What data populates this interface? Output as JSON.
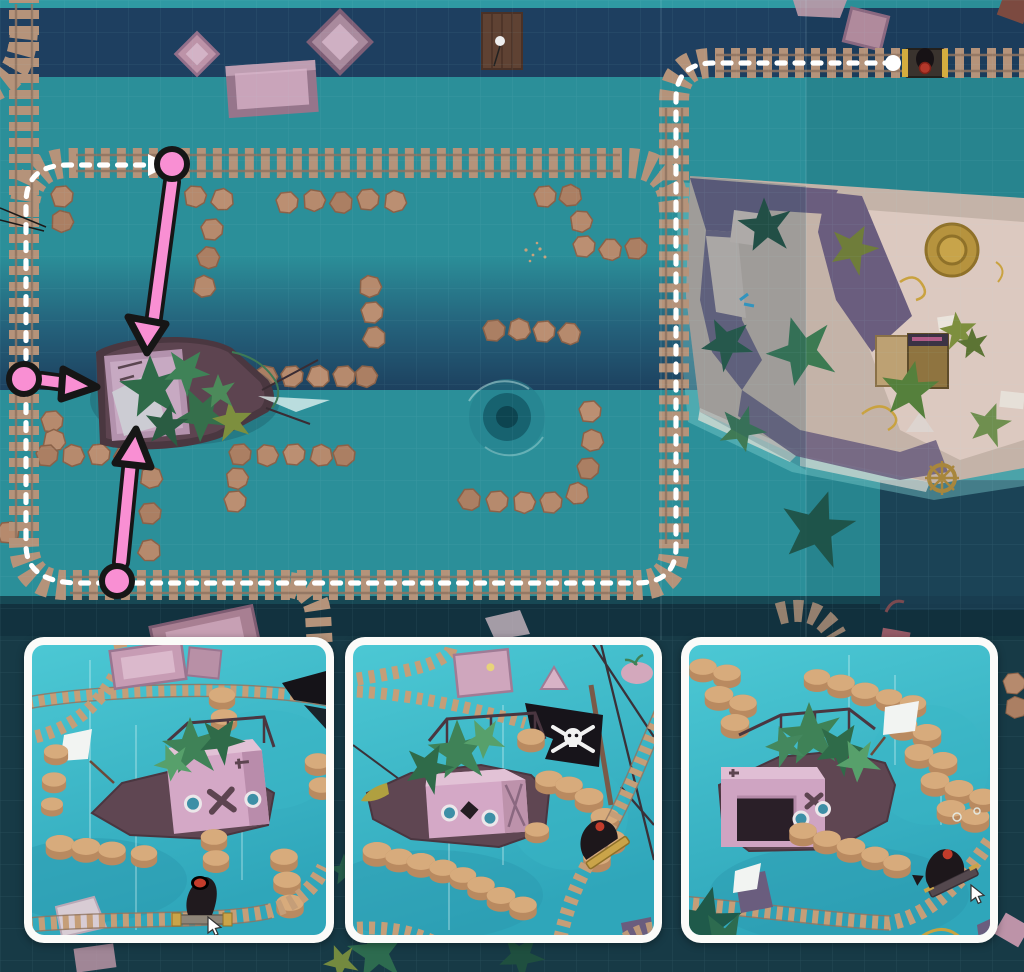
{
  "scene": {
    "kind": "puzzle-game walkthrough screenshot",
    "view": "top-down track map with three 3D close-up insets",
    "contains_text": false
  },
  "palette": {
    "water_teal": "#2b8f99",
    "water_deep": "#1e3f60",
    "water_band": "#1d415f",
    "water_bottom": "#173a46",
    "track_tie": "#b5937a",
    "track_rail": "#8f7360",
    "stone": "#b68a6d",
    "stone_edge": "#8a6148",
    "annotation_pink": "#f98fd3",
    "annotation_outline": "#161616",
    "route_white": "#ffffff",
    "ship_hull": "#5d4450",
    "ship_cabin": "#c9a3be",
    "island_sand": "#c4b3a8",
    "island_rock": "#6a5d7e",
    "island_inner_sand": "#dcc9c0",
    "palm_green": "#3c7a52",
    "palm_olive": "#7d8f3e",
    "rope_gold": "#c9a23f",
    "panel_border": "#fbfbf9",
    "panel_water_top": "#4cc8d4",
    "panel_water_bottom": "#2fa6ba",
    "cannon_black": "#1d171b",
    "cannon_muzzle_red": "#c23c2b",
    "cart_gold": "#caa449",
    "pirate_flag": "#17141a",
    "white_flag": "#f2f4f2"
  },
  "overview": {
    "route": {
      "start_dot": {
        "x": 893,
        "y": 63
      },
      "course": "from cannon cart at top-right, left along top track, down right side, counter-clockwise around the loop, ending with a right-pointing arrow on the upper loop track",
      "arrow_end": {
        "x": 158,
        "y": 165
      }
    },
    "cannon_cart": {
      "x": 925,
      "y": 63
    },
    "shipwreck_center": {
      "x": 180,
      "y": 395
    },
    "whirlpool": {
      "x": 507,
      "y": 417
    },
    "pink_markers": [
      {
        "id": 1,
        "circle": {
          "x": 172,
          "y": 164
        },
        "tip": {
          "x": 147,
          "y": 353
        },
        "direction": "down-toward-ship"
      },
      {
        "id": 2,
        "circle": {
          "x": 24,
          "y": 379
        },
        "tip": {
          "x": 97,
          "y": 387
        },
        "direction": "right-toward-ship"
      },
      {
        "id": 3,
        "circle": {
          "x": 117,
          "y": 581
        },
        "tip": {
          "x": 136,
          "y": 429
        },
        "direction": "up-toward-ship"
      }
    ],
    "island": {
      "position": "right side",
      "features": [
        "palm trees",
        "hut",
        "gold medallion",
        "ship wheel",
        "ropes",
        "papers",
        "blue bird"
      ]
    }
  },
  "panels": [
    {
      "id": "closeup-left",
      "cannon": "bottom-center pointing up",
      "cursor": true,
      "white_flag": true,
      "pirate_flag": false
    },
    {
      "id": "closeup-middle",
      "cannon": "right on curved track",
      "cursor": false,
      "white_flag": false,
      "pirate_flag": true
    },
    {
      "id": "closeup-right",
      "cannon": "right on diagonal track",
      "cursor": true,
      "white_flag": true,
      "pirate_flag": false
    }
  ]
}
